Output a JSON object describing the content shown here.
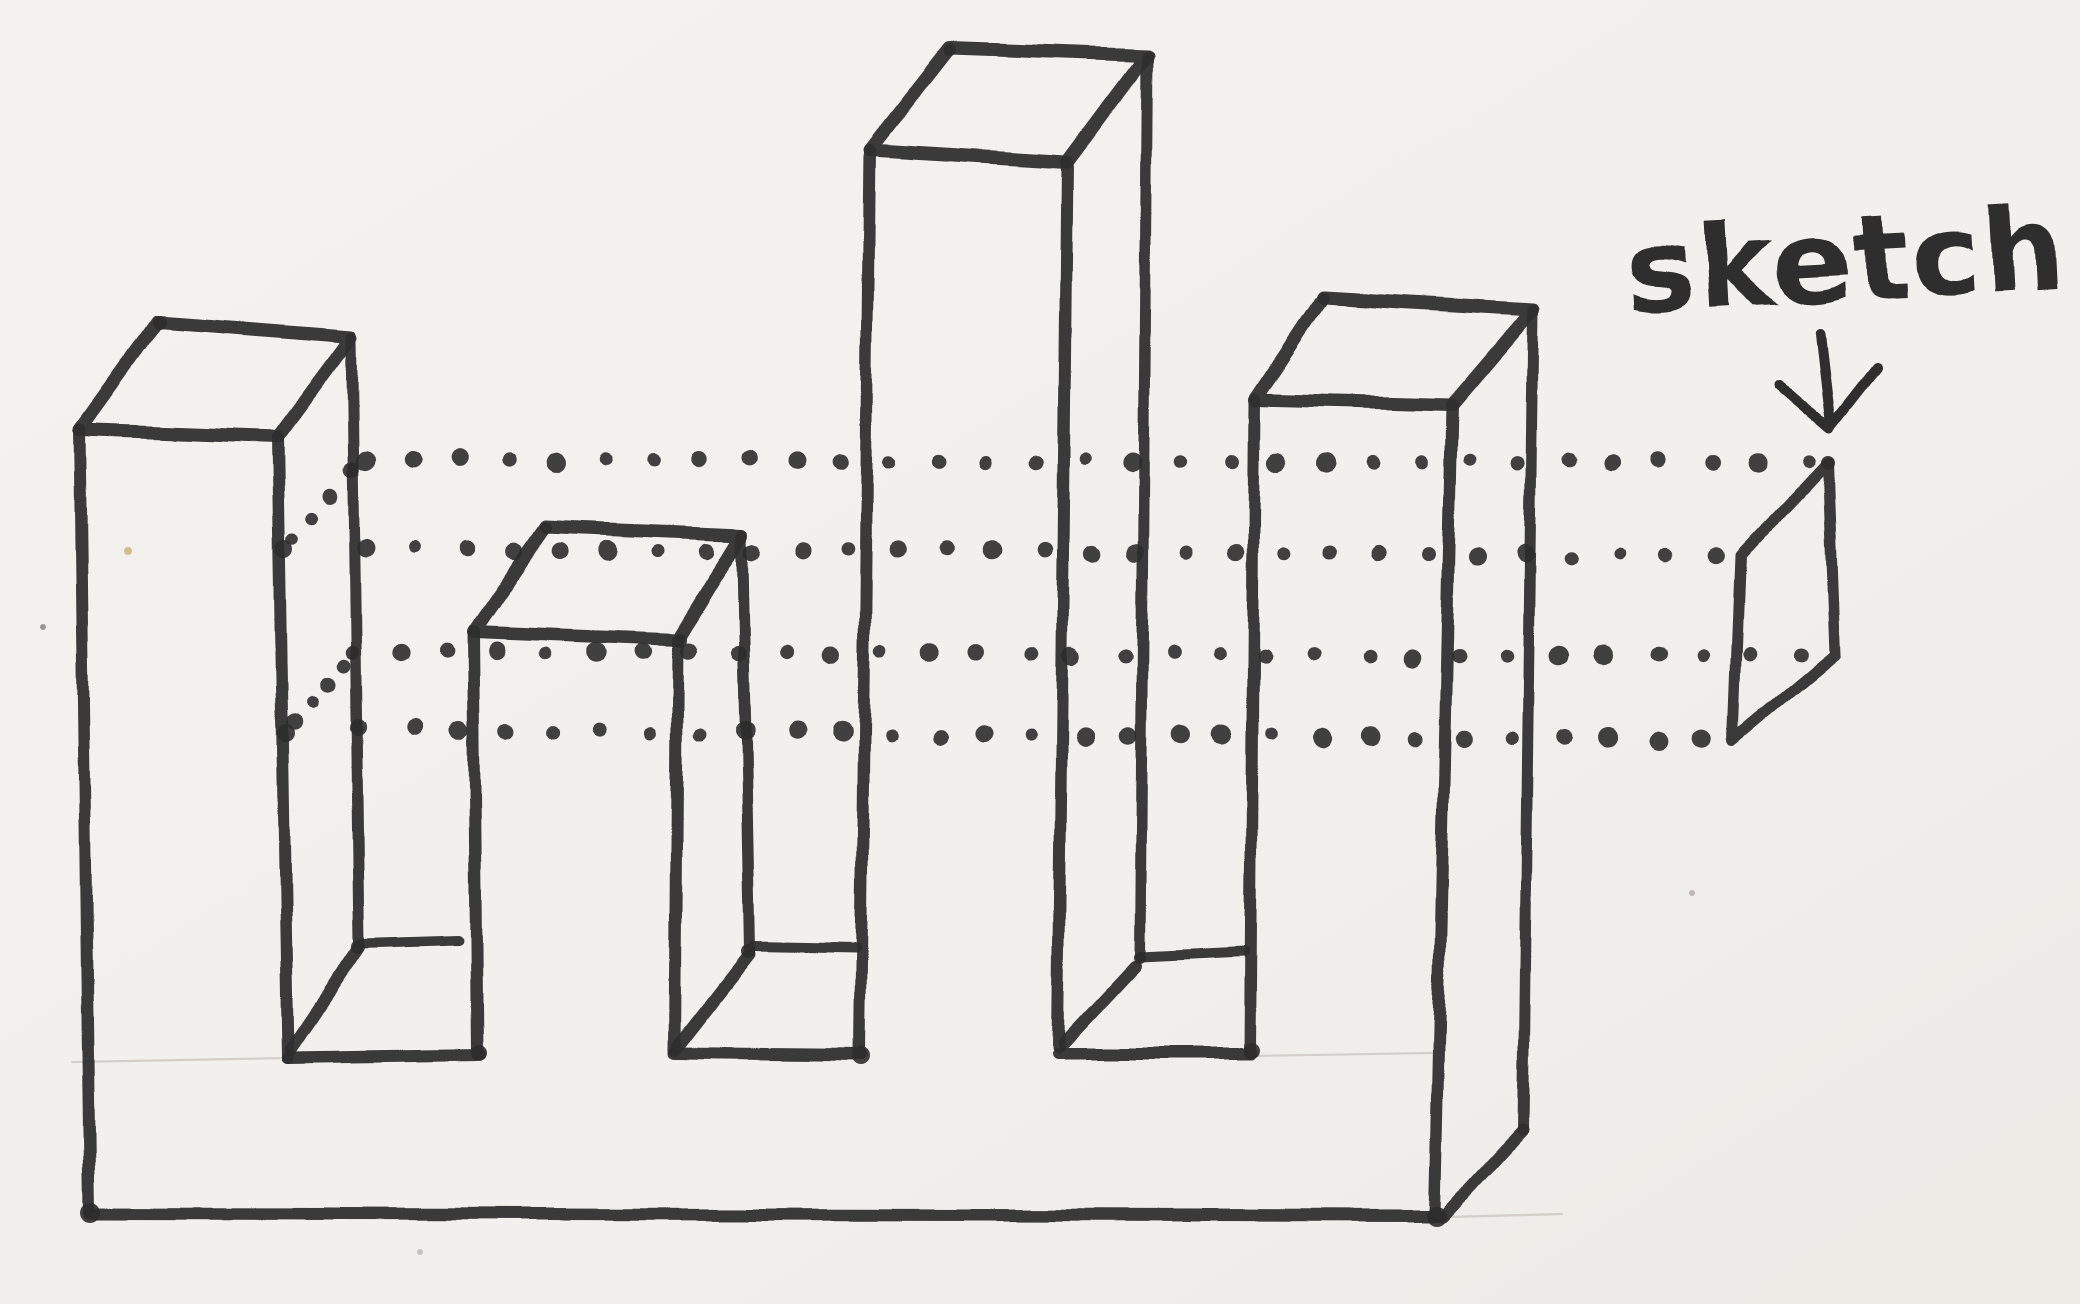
{
  "annotation": {
    "label": "sketch"
  },
  "colors": {
    "paper": "#f3f1ee",
    "paper_edge": "#eceae5",
    "ink": "#2d2d2d",
    "pencil": "#c9c3bb"
  },
  "canvas": {
    "width": 2080,
    "height": 1304
  },
  "diagram": {
    "type": "hand-drawn-extrusion-projection-sketch",
    "towers_count": 4,
    "projection_lines_count": 4,
    "strokes": [
      {
        "name": "tower-1-top-face",
        "w": 13,
        "closed": true,
        "pts": [
          [
            80,
            430
          ],
          [
            158,
            322
          ],
          [
            352,
            337
          ],
          [
            278,
            437
          ]
        ]
      },
      {
        "name": "tower-1-left-edge",
        "w": 12,
        "pts": [
          [
            80,
            430
          ],
          [
            90,
            1213
          ]
        ]
      },
      {
        "name": "tower-1-front-right-edge",
        "w": 12,
        "pts": [
          [
            278,
            437
          ],
          [
            288,
            1058
          ]
        ]
      },
      {
        "name": "tower-1-back-right-edge",
        "w": 11,
        "pts": [
          [
            352,
            337
          ],
          [
            360,
            944
          ]
        ]
      },
      {
        "name": "notch-1-floor-front-edge",
        "w": 12,
        "pts": [
          [
            288,
            1058
          ],
          [
            480,
            1055
          ]
        ]
      },
      {
        "name": "notch-1-floor-back-edge",
        "w": 10,
        "pts": [
          [
            362,
            944
          ],
          [
            458,
            941
          ]
        ]
      },
      {
        "name": "notch-1-floor-left-edge",
        "w": 12,
        "pts": [
          [
            358,
            950
          ],
          [
            291,
            1049
          ]
        ]
      },
      {
        "name": "tower-2-top-face",
        "w": 13,
        "closed": true,
        "pts": [
          [
            473,
            632
          ],
          [
            545,
            527
          ],
          [
            742,
            535
          ],
          [
            678,
            640
          ]
        ]
      },
      {
        "name": "tower-2-front-left-edge",
        "w": 12,
        "pts": [
          [
            473,
            632
          ],
          [
            477,
            1053
          ]
        ]
      },
      {
        "name": "tower-2-front-right-edge",
        "w": 12,
        "pts": [
          [
            678,
            640
          ],
          [
            675,
            1050
          ]
        ]
      },
      {
        "name": "tower-2-back-right-edge",
        "w": 11,
        "pts": [
          [
            742,
            535
          ],
          [
            750,
            950
          ]
        ]
      },
      {
        "name": "notch-2-floor-front-edge",
        "w": 12,
        "pts": [
          [
            675,
            1053
          ],
          [
            862,
            1055
          ]
        ]
      },
      {
        "name": "notch-2-floor-back-edge",
        "w": 10,
        "pts": [
          [
            753,
            946
          ],
          [
            856,
            948
          ]
        ]
      },
      {
        "name": "notch-2-floor-left-edge",
        "w": 12,
        "pts": [
          [
            750,
            954
          ],
          [
            678,
            1046
          ]
        ]
      },
      {
        "name": "tower-3-top-face",
        "w": 13,
        "closed": true,
        "pts": [
          [
            870,
            150
          ],
          [
            950,
            48
          ],
          [
            1147,
            55
          ],
          [
            1067,
            162
          ]
        ]
      },
      {
        "name": "tower-3-front-left-edge",
        "w": 12,
        "pts": [
          [
            870,
            150
          ],
          [
            860,
            1053
          ]
        ]
      },
      {
        "name": "tower-3-front-right-edge",
        "w": 12,
        "pts": [
          [
            1067,
            162
          ],
          [
            1058,
            1047
          ]
        ]
      },
      {
        "name": "tower-3-back-right-edge",
        "w": 11,
        "pts": [
          [
            1147,
            55
          ],
          [
            1140,
            955
          ]
        ]
      },
      {
        "name": "notch-3-floor-front-edge",
        "w": 12,
        "pts": [
          [
            1058,
            1053
          ],
          [
            1252,
            1053
          ]
        ]
      },
      {
        "name": "notch-3-floor-back-edge",
        "w": 10,
        "pts": [
          [
            1140,
            956
          ],
          [
            1245,
            951
          ]
        ]
      },
      {
        "name": "notch-3-floor-left-edge",
        "w": 12,
        "pts": [
          [
            1135,
            965
          ],
          [
            1063,
            1042
          ]
        ]
      },
      {
        "name": "tower-4-top-face",
        "w": 13,
        "closed": true,
        "pts": [
          [
            1255,
            400
          ],
          [
            1323,
            298
          ],
          [
            1533,
            310
          ],
          [
            1452,
            405
          ]
        ]
      },
      {
        "name": "tower-4-front-left-edge",
        "w": 12,
        "pts": [
          [
            1255,
            400
          ],
          [
            1250,
            1052
          ]
        ]
      },
      {
        "name": "tower-4-front-right-edge",
        "w": 12,
        "pts": [
          [
            1452,
            405
          ],
          [
            1435,
            1215
          ]
        ]
      },
      {
        "name": "tower-4-back-right-edge",
        "w": 11,
        "pts": [
          [
            1533,
            310
          ],
          [
            1523,
            1130
          ]
        ]
      },
      {
        "name": "base-bottom-right-edge",
        "w": 12,
        "pts": [
          [
            1523,
            1130
          ],
          [
            1443,
            1217
          ]
        ]
      },
      {
        "name": "base-bottom-front-edge",
        "w": 12,
        "pts": [
          [
            90,
            1213
          ],
          [
            1437,
            1216
          ]
        ]
      },
      {
        "name": "profile-parallelogram",
        "w": 11,
        "closed": true,
        "pts": [
          [
            1828,
            462
          ],
          [
            1740,
            556
          ],
          [
            1733,
            740
          ],
          [
            1835,
            655
          ]
        ]
      }
    ],
    "pencil_lines": [
      {
        "name": "guide-line-left",
        "pts": [
          [
            72,
            1062
          ],
          [
            288,
            1058
          ]
        ]
      },
      {
        "name": "guide-line-under-tower-4",
        "pts": [
          [
            1252,
            1056
          ],
          [
            1432,
            1053
          ]
        ]
      },
      {
        "name": "guide-line-bottom-right",
        "pts": [
          [
            1447,
            1217
          ],
          [
            1562,
            1214
          ]
        ]
      }
    ],
    "dotted_lines": [
      {
        "name": "projection-line-1",
        "from": [
          363,
          459
        ],
        "to": [
          1806,
          463
        ],
        "spacing": 48,
        "r": 8
      },
      {
        "name": "projection-line-2",
        "from": [
          368,
          548
        ],
        "to": [
          1716,
          556
        ],
        "spacing": 48,
        "r": 8
      },
      {
        "name": "projection-line-3",
        "from": [
          350,
          652
        ],
        "to": [
          1800,
          656
        ],
        "spacing": 48,
        "r": 8
      },
      {
        "name": "projection-line-4",
        "from": [
          362,
          730
        ],
        "to": [
          1706,
          739
        ],
        "spacing": 48,
        "r": 8
      },
      {
        "name": "projection-lead-in-upper",
        "from": [
          293,
          540
        ],
        "to": [
          352,
          470
        ],
        "spacing": 33,
        "r": 7
      },
      {
        "name": "projection-lead-in-lower",
        "from": [
          295,
          724
        ],
        "to": [
          345,
          662
        ],
        "spacing": 31,
        "r": 7
      }
    ],
    "blobs": [
      [
        283,
        549,
        9
      ],
      [
        286,
        733,
        9
      ],
      [
        90,
        1213,
        10
      ],
      [
        479,
        1053,
        8
      ],
      [
        861,
        1055,
        9
      ],
      [
        1252,
        1051,
        8
      ],
      [
        1437,
        1217,
        10
      ],
      [
        680,
        641,
        7
      ],
      [
        1828,
        463,
        7
      ],
      [
        358,
        947,
        7
      ],
      [
        748,
        951,
        7
      ],
      [
        160,
        323,
        7
      ],
      [
        546,
        528,
        6
      ],
      [
        950,
        50,
        6
      ],
      [
        1324,
        299,
        6
      ],
      [
        1140,
        958,
        6
      ]
    ],
    "specks": [
      [
        43,
        627,
        3,
        "#9a9792"
      ],
      [
        128,
        551,
        4,
        "#cfc08e"
      ],
      [
        1692,
        893,
        3,
        "#bdb9b2"
      ],
      [
        420,
        1252,
        3,
        "#c6c2bc"
      ]
    ],
    "arrow": {
      "shaft": [
        [
          1821,
          333
        ],
        [
          1831,
          420
        ]
      ],
      "head": [
        [
          1779,
          384
        ],
        [
          1830,
          428
        ],
        [
          1877,
          368
        ]
      ],
      "w": 10
    },
    "label": {
      "x": 1628,
      "y": 312,
      "size": 116,
      "rotate": -3,
      "letter_spacing": 2
    }
  }
}
